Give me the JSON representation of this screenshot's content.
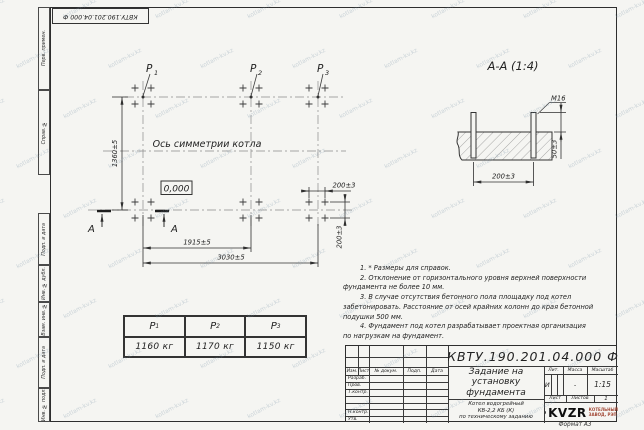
{
  "watermark": "kotlam-kv.kz",
  "stamp_top": "КВТУ.190.201.04.000 Ф",
  "side_strip": {
    "labels": [
      "Перв. примен.",
      "Справ. №",
      "Подп. и дата",
      "Инв. № дубл.",
      "Взам. инв. №",
      "Подп. и дата",
      "Инв. № подл."
    ]
  },
  "plan": {
    "p_labels": [
      {
        "base": "P",
        "sub": "1"
      },
      {
        "base": "P",
        "sub": "2"
      },
      {
        "base": "P",
        "sub": "3"
      }
    ],
    "axis_label": "Ось симметрии котла",
    "elevation": "0,000",
    "section_letter_left": "А",
    "section_letter_right": "А",
    "dims": {
      "height": "1360±5",
      "inner_width": "1915±5",
      "total_width": "3030±5",
      "bolt_spacing_x": "200±3",
      "bolt_spacing_y": "200±3"
    }
  },
  "section": {
    "title": "А-А (1:4)",
    "thread": "M16",
    "dims": {
      "protrusion": "50±3",
      "spacing": "200±3"
    }
  },
  "notes": {
    "lines": [
      "1. * Размеры для справок.",
      "2. Отклонение от горизонтального уровня верхней поверхности",
      "фундамента не более 10 мм.",
      "3. В случае отсутствия бетонного пола площадку под котел",
      "забетонировать. Расстояние от осей крайних колонн до края бетонной",
      "подушки 500 мм.",
      "4. Фундамент под котел разрабатывает проектная организация",
      "по нагрузкам на фундамент."
    ]
  },
  "load_table": {
    "headers": [
      {
        "base": "P",
        "sub": "1"
      },
      {
        "base": "P",
        "sub": "2"
      },
      {
        "base": "P",
        "sub": "3"
      }
    ],
    "values": [
      "1160 кг",
      "1170 кг",
      "1150 кг"
    ]
  },
  "title_block": {
    "doc_number": "КВТУ.190.201.04.000 Ф",
    "title_lines": [
      "Задание на",
      "установку",
      "фундамента"
    ],
    "product_lines": [
      "Котел водогрейный",
      "КВ-2,2 КБ (К)",
      "по техническому заданию"
    ],
    "columns": [
      "Изм.",
      "Лист",
      "№ докум.",
      "Подп.",
      "Дата"
    ],
    "rows": [
      "Разраб.",
      "Пров.",
      "Т.контр.",
      "",
      "",
      "Н.контр.",
      "Утв."
    ],
    "lit": {
      "label": "Лит.",
      "value": "И"
    },
    "mass": {
      "label": "Масса",
      "value": "-"
    },
    "scale": {
      "label": "Масштаб",
      "value": "1:15"
    },
    "sheet": {
      "label": "Лист",
      "total_label": "Листов",
      "total_value": "1"
    },
    "logo": {
      "text": "KVZR",
      "caption_lines": [
        "КОТЕЛЬНЫЙ",
        "ЗАВОД, РЭП"
      ]
    },
    "format": "Формат А3"
  },
  "colors": {
    "line": "#2f2f2f",
    "thin_line": "#888888",
    "logo_red": "#a34a38",
    "watermark": "#7892a6",
    "paper": "#f5f5f2"
  }
}
